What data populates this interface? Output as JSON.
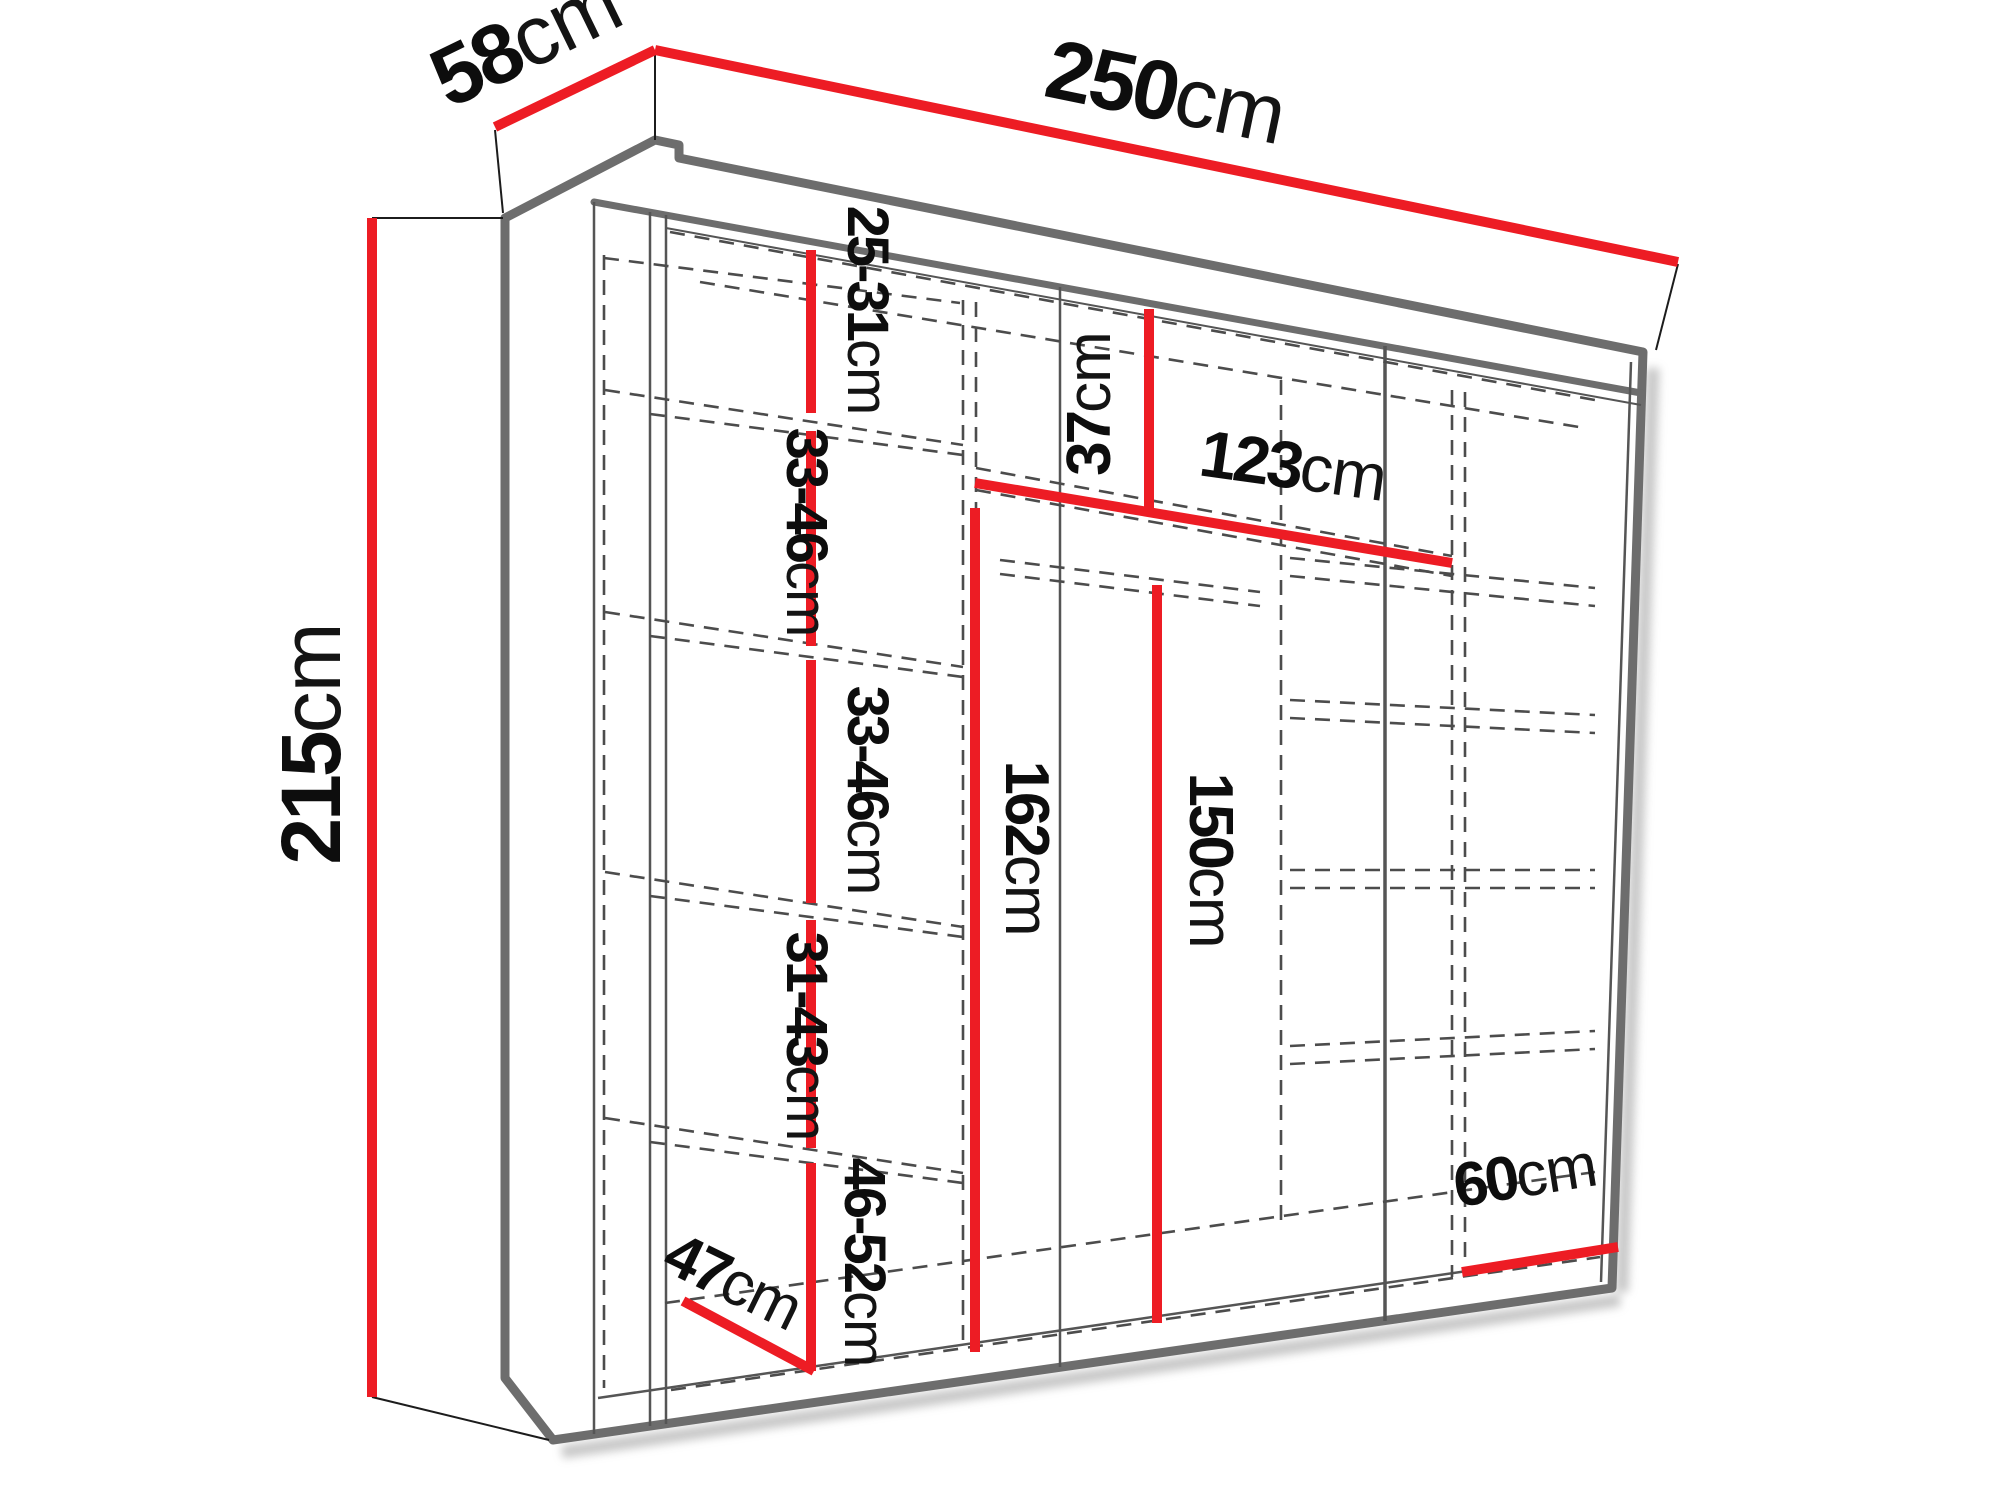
{
  "diagram": {
    "type": "wardrobe-dimension-diagram",
    "unit": "cm",
    "colors": {
      "dimension_line": "#ed1c24",
      "outline": "#6d6d6d",
      "hidden_line": "#4c4c4c",
      "label_text": "#0d0d0d",
      "background": "#ffffff"
    },
    "overall": {
      "width": {
        "num": "250",
        "unit": "cm"
      },
      "depth": {
        "num": "58",
        "unit": "cm"
      },
      "height": {
        "num": "215",
        "unit": "cm"
      }
    },
    "interior": {
      "left_column_sections": [
        {
          "num": "25-31",
          "unit": "cm"
        },
        {
          "num": "33-46",
          "unit": "cm"
        },
        {
          "num": "33-46",
          "unit": "cm"
        },
        {
          "num": "31-43",
          "unit": "cm"
        },
        {
          "num": "46-52",
          "unit": "cm"
        }
      ],
      "top_shelf_gap": {
        "num": "37",
        "unit": "cm"
      },
      "shelf_width": {
        "num": "123",
        "unit": "cm"
      },
      "hanging_space_left": {
        "num": "162",
        "unit": "cm"
      },
      "hanging_space_right": {
        "num": "150",
        "unit": "cm"
      },
      "floor_depth": {
        "num": "47",
        "unit": "cm"
      },
      "right_column_width": {
        "num": "60",
        "unit": "cm"
      }
    }
  }
}
